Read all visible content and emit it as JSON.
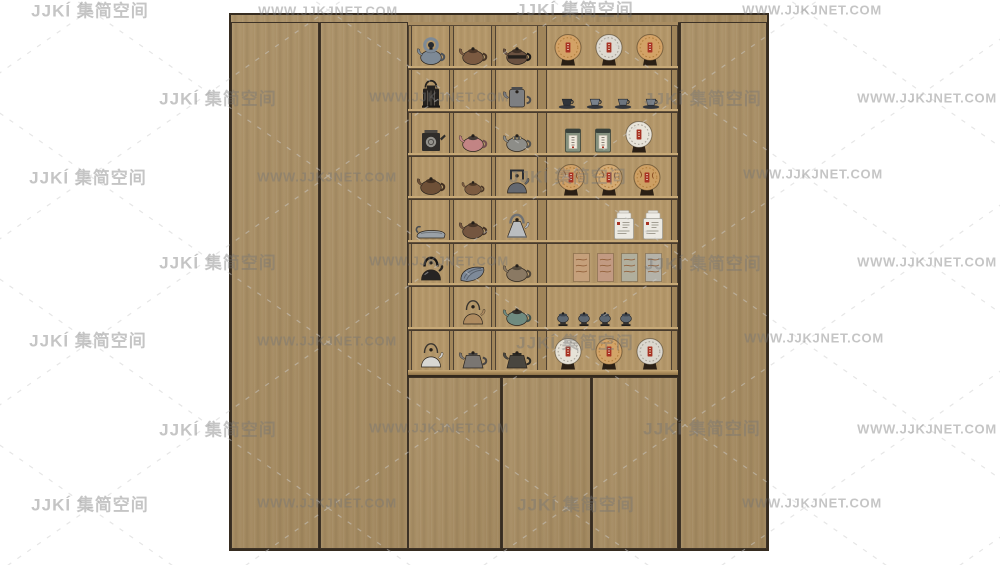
{
  "watermark": {
    "logo_text": "JJKÍ 集简空间",
    "url_text": "WWW.JJKJNET.COM",
    "text_color": "#747474",
    "lattice_color": "#cccccc",
    "positions": [
      {
        "k": "logo",
        "x": 90,
        "y": 9
      },
      {
        "k": "url",
        "x": 328,
        "y": 11
      },
      {
        "k": "logo",
        "x": 575,
        "y": 8
      },
      {
        "k": "url",
        "x": 812,
        "y": 10
      },
      {
        "k": "logo",
        "x": 218,
        "y": 97
      },
      {
        "k": "url",
        "x": 439,
        "y": 97
      },
      {
        "k": "logo",
        "x": 703,
        "y": 97
      },
      {
        "k": "url",
        "x": 927,
        "y": 98
      },
      {
        "k": "logo",
        "x": 88,
        "y": 176
      },
      {
        "k": "url",
        "x": 327,
        "y": 177
      },
      {
        "k": "logo",
        "x": 568,
        "y": 175
      },
      {
        "k": "url",
        "x": 813,
        "y": 174
      },
      {
        "k": "logo",
        "x": 218,
        "y": 261
      },
      {
        "k": "url",
        "x": 439,
        "y": 261
      },
      {
        "k": "logo",
        "x": 703,
        "y": 262
      },
      {
        "k": "url",
        "x": 927,
        "y": 262
      },
      {
        "k": "logo",
        "x": 88,
        "y": 339
      },
      {
        "k": "url",
        "x": 327,
        "y": 341
      },
      {
        "k": "logo",
        "x": 575,
        "y": 341
      },
      {
        "k": "url",
        "x": 814,
        "y": 338
      },
      {
        "k": "logo",
        "x": 218,
        "y": 428
      },
      {
        "k": "url",
        "x": 439,
        "y": 428
      },
      {
        "k": "logo",
        "x": 702,
        "y": 427
      },
      {
        "k": "url",
        "x": 927,
        "y": 429
      },
      {
        "k": "logo",
        "x": 90,
        "y": 503
      },
      {
        "k": "url",
        "x": 327,
        "y": 503
      },
      {
        "k": "logo",
        "x": 576,
        "y": 503
      },
      {
        "k": "url",
        "x": 812,
        "y": 503
      }
    ]
  },
  "cabinet": {
    "wood_color": "#a78c61",
    "interior_color": "#b5986a",
    "shelf_edge_color": "#c7a977",
    "outline_color": "#362c20",
    "description": "tea display cabinet with two left doors, central shelf grid, three lower doors and one right door"
  },
  "shelf": {
    "grid": {
      "pitch": 43.5,
      "bar": 4,
      "rows": 8,
      "rail_y": 348,
      "height": 355,
      "stiles": [
        {
          "x": 0,
          "w": 4
        },
        {
          "x": 41,
          "w": 5
        },
        {
          "x": 83,
          "w": 5
        },
        {
          "x": 129,
          "w": 10
        },
        {
          "x": 263,
          "w": 7
        }
      ],
      "cols": [
        {
          "x": 4,
          "w": 37
        },
        {
          "x": 46,
          "w": 37
        },
        {
          "x": 88,
          "w": 41
        },
        {
          "x": 139,
          "w": 124
        }
      ]
    },
    "rows": [
      {
        "cells": [
          {
            "items": [
              {
                "t": "pot",
                "c": "#7e8a96",
                "loop": 1,
                "name": "blue-grey-loop-teapot"
              }
            ]
          },
          {
            "items": [
              {
                "t": "pot",
                "c": "#7b5a41",
                "name": "brown-teapot"
              }
            ]
          },
          {
            "items": [
              {
                "t": "pot",
                "c": "#6a5140",
                "band": "#24201c",
                "name": "dark-banded-teapot"
              }
            ]
          },
          {
            "gap": 9,
            "items": [
              {
                "t": "disc",
                "f": "#d3a266",
                "name": "tea-cake-disc"
              },
              {
                "t": "disc",
                "f": "#dedad1",
                "wh": 1,
                "name": "tea-cake-disc"
              },
              {
                "t": "disc",
                "f": "#d3a266",
                "name": "tea-cake-disc"
              }
            ]
          }
        ]
      },
      {
        "cells": [
          {
            "items": [
              {
                "t": "lantern",
                "c": "#24211e",
                "name": "black-lantern-teapot"
              }
            ]
          },
          null,
          {
            "items": [
              {
                "t": "pot",
                "c": "#7d7f82",
                "tall": 1,
                "name": "grey-metal-pot"
              }
            ]
          },
          {
            "gap": 7,
            "items": [
              {
                "t": "cup",
                "c": "#30343a",
                "name": "teacup"
              },
              {
                "t": "cup",
                "c": "#7a828c",
                "name": "teacup"
              },
              {
                "t": "cup",
                "c": "#6d757f",
                "name": "teacup"
              },
              {
                "t": "cup",
                "c": "#7a828c",
                "name": "teacup"
              }
            ]
          }
        ]
      },
      {
        "cells": [
          {
            "items": [
              {
                "t": "caddy",
                "c": "#2f2d2a",
                "name": "tea-caddy"
              }
            ]
          },
          {
            "items": [
              {
                "t": "pot",
                "c": "#c28484",
                "lid": "#443b36",
                "name": "pink-teapot"
              }
            ]
          },
          {
            "items": [
              {
                "t": "pot",
                "c": "#8d8d88",
                "stripe": 1,
                "name": "striped-lid-teapot"
              }
            ]
          },
          {
            "gap": 10,
            "items": [
              {
                "t": "tin",
                "c": "#84917e",
                "name": "tea-tin"
              },
              {
                "t": "tin",
                "c": "#84917e",
                "name": "tea-tin"
              },
              {
                "t": "disc",
                "f": "#e8e4d9",
                "wh": 1,
                "name": "white-tea-cake"
              }
            ]
          }
        ]
      },
      {
        "cells": [
          {
            "items": [
              {
                "t": "pot",
                "c": "#6e5037",
                "name": "brown-teapot"
              }
            ]
          },
          {
            "items": [
              {
                "t": "pot",
                "c": "#7c5b40",
                "small": 1,
                "name": "small-brown-teapot"
              }
            ]
          },
          {
            "items": [
              {
                "t": "kettle",
                "c": "#646870",
                "square": 1,
                "name": "iron-kettle"
              }
            ]
          },
          {
            "gap": 6,
            "items": [
              {
                "t": "disc",
                "f": "#d0a167",
                "m": 1,
                "name": "tea-cake-disc"
              },
              {
                "t": "disc",
                "f": "#d5ab73",
                "m": 1,
                "name": "tea-cake-disc"
              },
              {
                "t": "disc",
                "f": "#cd9f63",
                "m": 1,
                "name": "tea-cake-disc"
              }
            ]
          }
        ]
      },
      {
        "cells": [
          {
            "items": [
              {
                "t": "boat",
                "c": "#9aa1a7",
                "name": "tea-boat-scoop"
              }
            ]
          },
          {
            "items": [
              {
                "t": "pot",
                "c": "#745640",
                "name": "brown-teapot"
              }
            ]
          },
          {
            "items": [
              {
                "t": "kettle",
                "c": "#babdc0",
                "cone": 1,
                "name": "silver-kettle"
              }
            ]
          },
          {
            "justify": "flex-end",
            "padr": 6,
            "gap": 5,
            "items": [
              {
                "t": "canister",
                "name": "white-tea-canister"
              },
              {
                "t": "canister",
                "name": "white-tea-canister"
              }
            ]
          }
        ]
      },
      {
        "cells": [
          {
            "items": [
              {
                "t": "kettle",
                "c": "#262423",
                "name": "black-iron-teapot"
              }
            ]
          },
          {
            "items": [
              {
                "t": "leaf",
                "c": "#7e8a99",
                "name": "leaf-dish"
              }
            ]
          },
          {
            "items": [
              {
                "t": "pot",
                "c": "#8a7963",
                "name": "grey-brown-teapot"
              }
            ]
          },
          {
            "justify": "flex-end",
            "padr": 8,
            "gap": 5,
            "items": [
              {
                "t": "brick",
                "c": "#c5a07b",
                "name": "wrapped-tea-brick"
              },
              {
                "t": "brick",
                "c": "#c29a82",
                "name": "wrapped-tea-brick"
              },
              {
                "t": "brick",
                "c": "#b1af9d",
                "name": "wrapped-tea-brick"
              },
              {
                "t": "brick",
                "c": "#b4b2a9",
                "name": "wrapped-tea-brick"
              }
            ]
          }
        ]
      },
      {
        "cells": [
          null,
          {
            "items": [
              {
                "t": "kettle",
                "c": "#ae8b60",
                "wire": 1,
                "name": "tan-wire-handle-kettle"
              }
            ]
          },
          {
            "items": [
              {
                "t": "pot",
                "c": "#6f8b80",
                "lid": "#33302c",
                "name": "teal-teapot"
              }
            ]
          },
          {
            "justify": "flex-start",
            "padl": 8,
            "gap": 5,
            "items": [
              {
                "t": "jar",
                "c": "#5d6771",
                "name": "covered-cup"
              },
              {
                "t": "jar",
                "c": "#5d6771",
                "name": "covered-cup"
              },
              {
                "t": "jar",
                "c": "#5d6771",
                "name": "covered-cup"
              },
              {
                "t": "jar",
                "c": "#5d6771",
                "name": "covered-cup"
              }
            ]
          }
        ]
      },
      {
        "cells": [
          {
            "items": [
              {
                "t": "kettle",
                "c": "#d8d7d3",
                "wire": 1,
                "name": "white-kettle"
              }
            ]
          },
          {
            "items": [
              {
                "t": "pot",
                "c": "#7a7672",
                "ang": 1,
                "name": "grey-angular-teapot"
              }
            ]
          },
          {
            "items": [
              {
                "t": "pot",
                "c": "#49463f",
                "ang": 1,
                "name": "dark-angular-teapot"
              }
            ]
          },
          {
            "gap": 9,
            "items": [
              {
                "t": "disc",
                "f": "#e6e2d7",
                "wh": 1,
                "name": "white-tea-cake"
              },
              {
                "t": "disc",
                "f": "#d3a468",
                "name": "tea-cake-disc"
              },
              {
                "t": "disc",
                "f": "#dbd7ce",
                "wh": 1,
                "name": "white-tea-cake"
              }
            ]
          }
        ]
      }
    ]
  }
}
